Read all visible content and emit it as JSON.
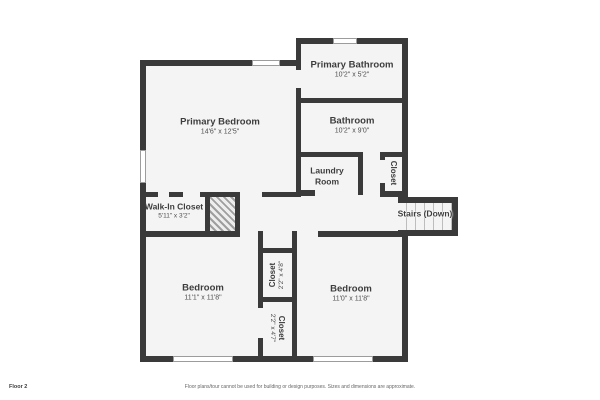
{
  "plan": {
    "rooms": {
      "primary_bedroom": {
        "name": "Primary Bedroom",
        "dims": "14'6\" x 12'5\""
      },
      "primary_bathroom": {
        "name": "Primary Bathroom",
        "dims": "10'2\" x 5'2\""
      },
      "bathroom": {
        "name": "Bathroom",
        "dims": "10'2\" x 9'0\""
      },
      "laundry_room": {
        "name": "Laundry Room"
      },
      "hall_closet": {
        "name": "Closet"
      },
      "stairs": {
        "name": "Stairs (Down)"
      },
      "walk_in_closet": {
        "name": "Walk-In Closet",
        "dims": "5'11\" x 3'2\""
      },
      "bedroom_left": {
        "name": "Bedroom",
        "dims": "11'1\" x 11'8\""
      },
      "closet_top": {
        "name": "Closet",
        "dims": "2'2\" x 4'8\""
      },
      "closet_bottom": {
        "name": "Closet",
        "dims": "2'2\" x 4'7\""
      },
      "bedroom_right": {
        "name": "Bedroom",
        "dims": "11'0\" x 11'8\""
      }
    }
  },
  "footer": {
    "floor_label": "Floor 2",
    "disclaimer": "Floor plans/tour cannot be used for building or design purposes. Sizes and dimensions are approximate."
  },
  "colors": {
    "wall": "#3a3a3a",
    "floor": "#f4f4f4",
    "text": "#3d3d3d",
    "winb": "#9c9c9c"
  }
}
